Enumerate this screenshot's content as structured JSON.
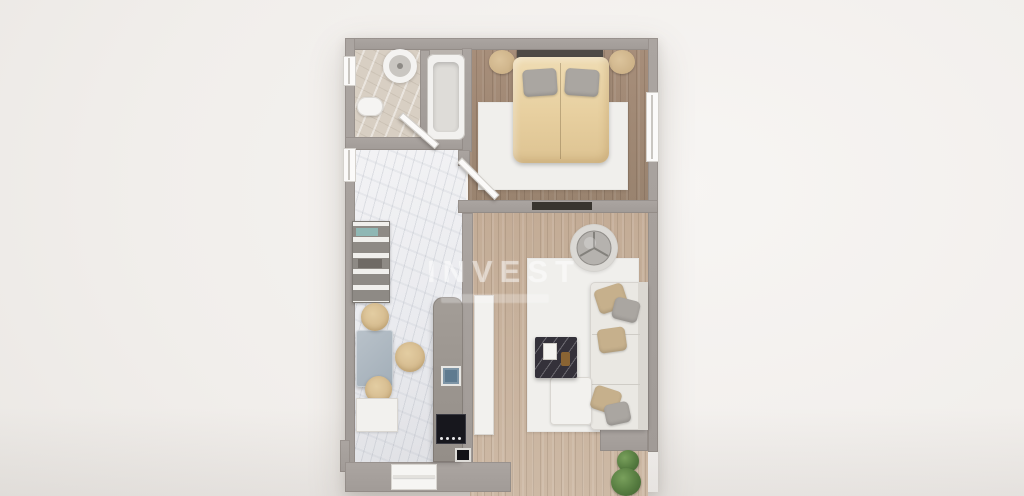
{
  "scene": {
    "description": "3D rendered apartment floor plan, top-down view, one-bedroom flat",
    "watermark": {
      "title": "INVEST"
    },
    "rooms": [
      {
        "name": "bathroom",
        "position": "top-left",
        "furniture": [
          "round-sink",
          "toilet",
          "bathtub",
          "door",
          "window"
        ]
      },
      {
        "name": "bedroom",
        "position": "top-right",
        "furniture": [
          "double-bed",
          "headboard",
          "pillow-left",
          "pillow-right",
          "nightstand-left",
          "nightstand-right",
          "white-rug",
          "tv-console",
          "window",
          "door"
        ]
      },
      {
        "name": "kitchen-hallway",
        "position": "left",
        "furniture": [
          "shelving-unit",
          "dining-table",
          "pouf-1",
          "pouf-2",
          "pouf-3",
          "white-desk",
          "kitchen-counter",
          "kitchen-sink",
          "cooktop",
          "oven",
          "entrance-door",
          "window"
        ]
      },
      {
        "name": "living-room",
        "position": "bottom-right",
        "furniture": [
          "corner-sofa",
          "ottoman",
          "cushions",
          "coffee-table",
          "candles",
          "round-rug",
          "armchair",
          "area-rug",
          "sideboard",
          "plant-small",
          "plant-large"
        ]
      }
    ],
    "palette": {
      "background": "#f1eeeb",
      "walls": "#a6a09c",
      "wood_floor_bedroom": "#a08873",
      "wood_floor_living": "#c6b09a",
      "marble_floor": "#eff0f2",
      "bathroom_floor": "#d8cfc3",
      "duvet": "#e9d3a6",
      "cushion_beige": "#c6b08c",
      "counter": "#9a948e",
      "kitchen_sink": "#7e95a6",
      "cooktop": "#17171d",
      "coffee_table": "#34313a",
      "plant": "#567c40"
    }
  }
}
